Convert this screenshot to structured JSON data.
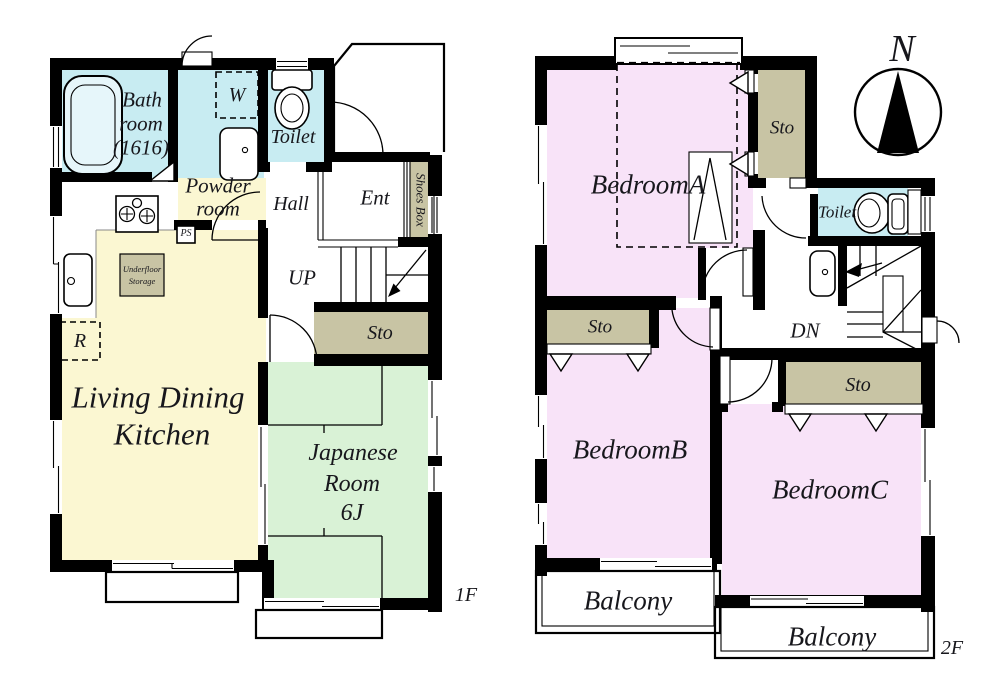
{
  "colors": {
    "water": "#c8ecf2",
    "ldk": "#fbf7d2",
    "tatami": "#d9f2d6",
    "bedroom": "#f8e3f8",
    "storage": "#c8c4a4",
    "wall": "#000000",
    "text": "#17171c"
  },
  "floor1": {
    "floor_label": "1F",
    "bathroom": {
      "line1": "Bath",
      "line2": "room",
      "line3": "(1616)"
    },
    "powder": {
      "line1": "Powder",
      "line2": "room"
    },
    "toilet": "Toilet",
    "hall": "Hall",
    "entrance": "Ent",
    "shoes_box": "Shoes Box",
    "up": "UP",
    "storage": "Sto",
    "washer": "W",
    "pipe_space": "PS",
    "refrigerator": "R",
    "underfloor": {
      "line1": "Underfloor",
      "line2": "Storage"
    },
    "ldk": {
      "line1": "Living Dining",
      "line2": "Kitchen"
    },
    "japanese_room": {
      "line1": "Japanese",
      "line2": "Room",
      "line3": "6J"
    }
  },
  "floor2": {
    "floor_label": "2F",
    "bedroom_a": "BedroomA",
    "bedroom_b": "BedroomB",
    "bedroom_c": "BedroomC",
    "storage_a": "Sto",
    "storage_b": "Sto",
    "storage_c": "Sto",
    "toilet": "Toilet",
    "down": "DN",
    "balcony_b": "Balcony",
    "balcony_c": "Balcony"
  },
  "compass": {
    "north": "N"
  }
}
